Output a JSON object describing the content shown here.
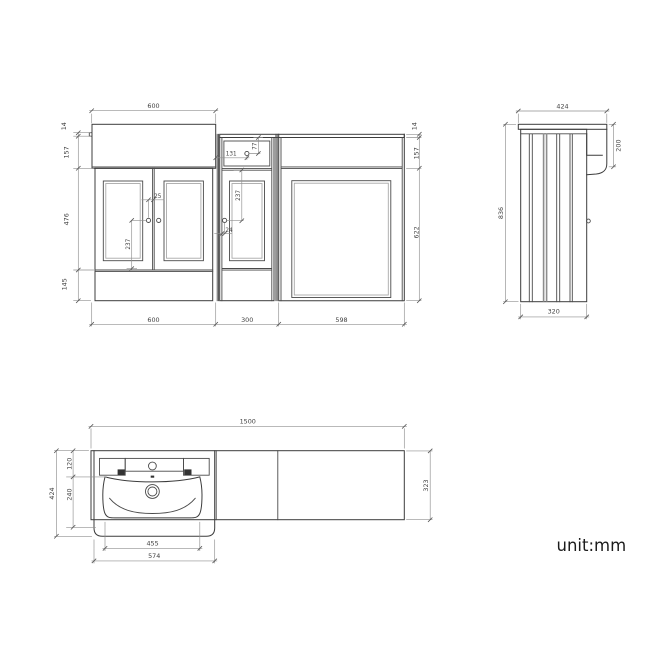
{
  "unit_label": "unit:mm",
  "front": {
    "top_width": "600",
    "left_worktop": "14",
    "left_apron": "157",
    "left_doors": "476",
    "left_plinth": "145",
    "right_worktop": "14",
    "right_apron": "157",
    "right_body": "622",
    "bottom_vanity": "600",
    "bottom_mid": "300",
    "bottom_wc": "598",
    "knob_offset": "25",
    "vanity_knob_drop": "237",
    "mid_knob_from_left": "131",
    "mid_knob_from_top": "77",
    "mid_knob_drop": "237",
    "mid_knob_edge": "24"
  },
  "side": {
    "worktop_depth": "424",
    "front_drop": "200",
    "height": "836",
    "body_depth": "320"
  },
  "plan": {
    "total_width": "1500",
    "vanity_depth": "424",
    "deck_depth": "120",
    "bowl_inner_depth": "240",
    "worktop_depth": "323",
    "bowl_width": "455",
    "vanity_width": "574"
  }
}
